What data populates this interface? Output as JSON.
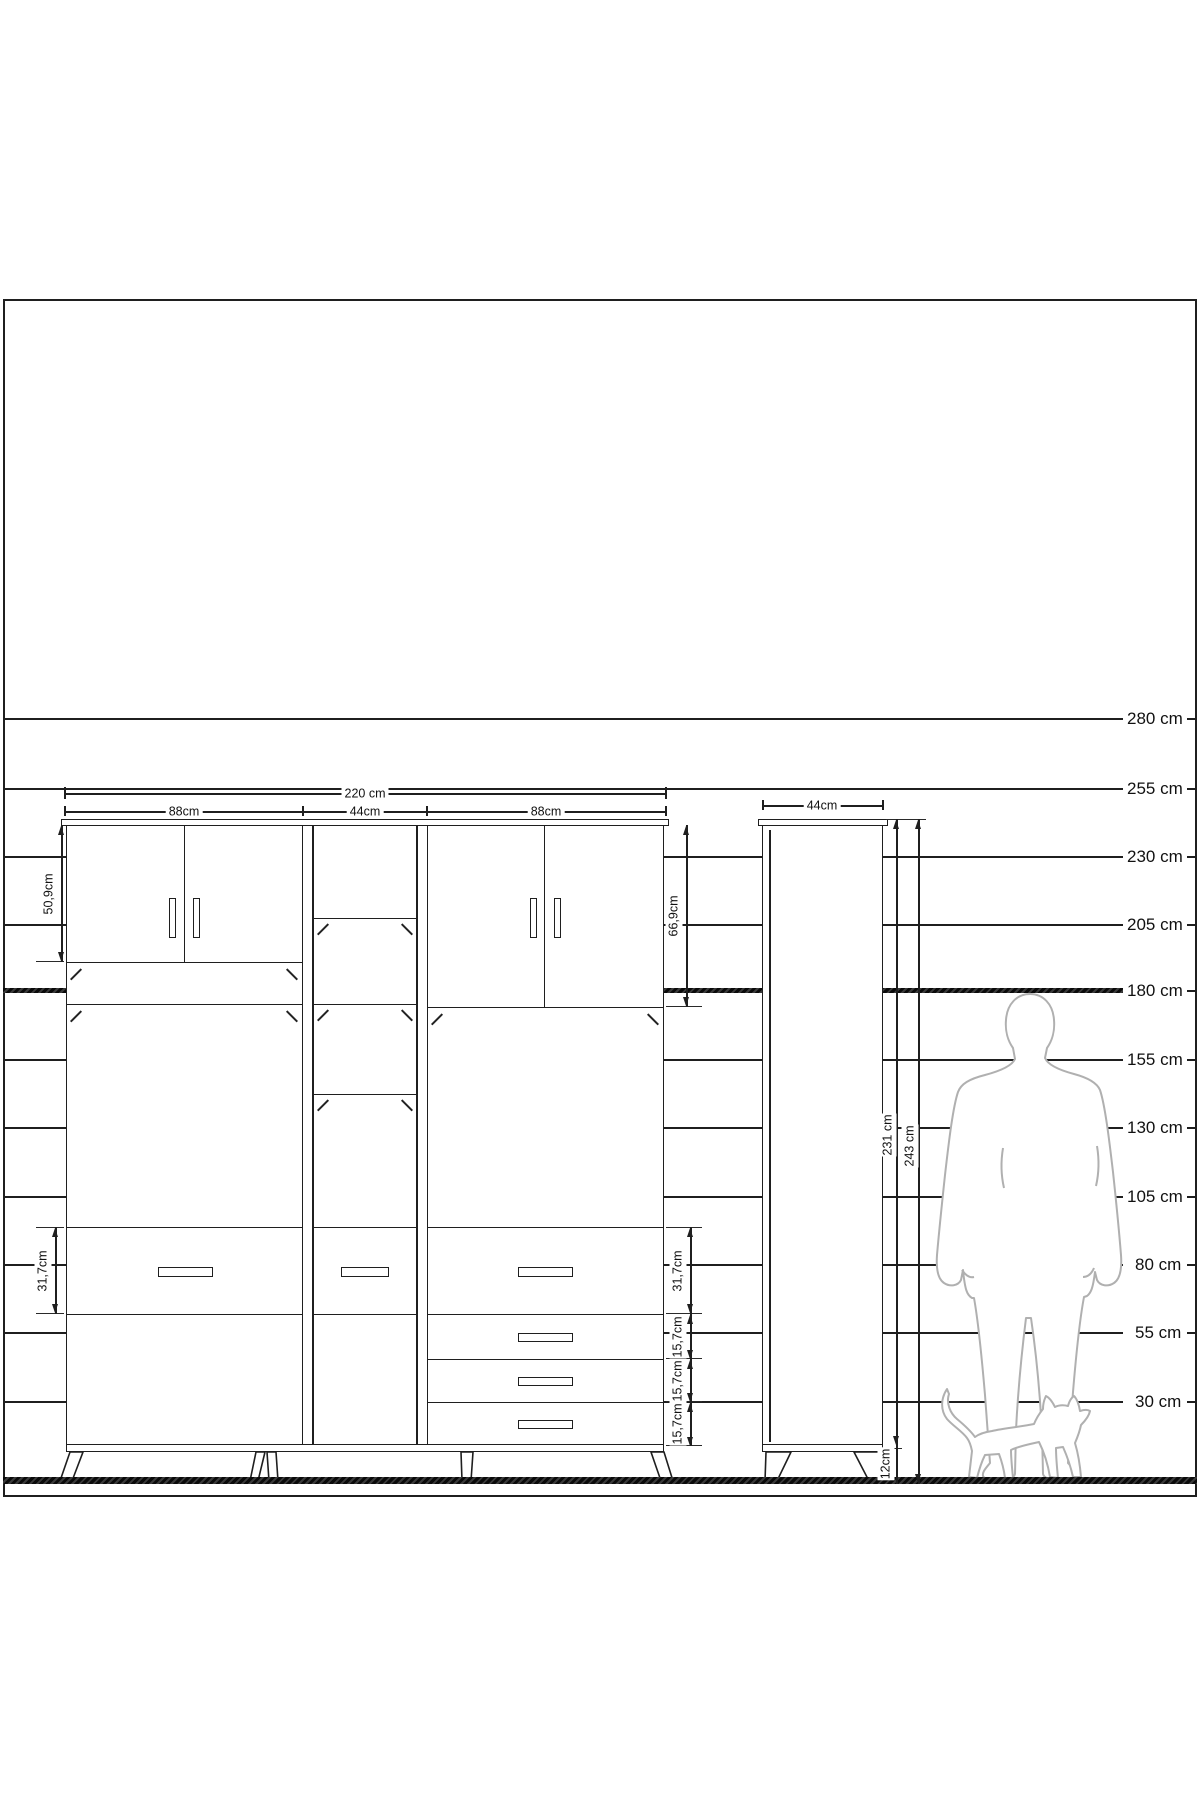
{
  "drawing": {
    "title_hint": "furniture elevation drawing with height scale, wardrobe unit, tall cabinet, man and cat silhouettes",
    "colors": {
      "line": "#1f1f1f",
      "silhouette": "#b0b0b0",
      "background": "#ffffff"
    },
    "scale_lines": [
      {
        "label": "280 cm",
        "y": 718
      },
      {
        "label": "255 cm",
        "y": 788
      },
      {
        "label": "230 cm",
        "y": 856
      },
      {
        "label": "205 cm",
        "y": 924
      },
      {
        "label": "180 cm",
        "y": 990,
        "bold": true
      },
      {
        "label": "155 cm",
        "y": 1059
      },
      {
        "label": "130 cm",
        "y": 1127
      },
      {
        "label": "105 cm",
        "y": 1196
      },
      {
        "label": "80 cm",
        "y": 1264
      },
      {
        "label": "55 cm",
        "y": 1332
      },
      {
        "label": "30 cm",
        "y": 1401
      }
    ],
    "main_cabinet": {
      "total_width_label": "220 cm",
      "section_width_labels": [
        "88cm",
        "44cm",
        "88cm"
      ],
      "left_doors_height_label": "50,9cm",
      "right_doors_height_label": "66,9cm",
      "drawer_row_height_label_left": "31,7cm",
      "drawer_row_height_label_right": "31,7cm",
      "small_drawer_height_labels": [
        "15,7cm",
        "15,7cm",
        "15,7cm"
      ]
    },
    "tall_cabinet": {
      "width_label": "44cm",
      "body_height_label": "231 cm",
      "total_height_label": "243 cm",
      "leg_height_label": "12cm"
    }
  }
}
